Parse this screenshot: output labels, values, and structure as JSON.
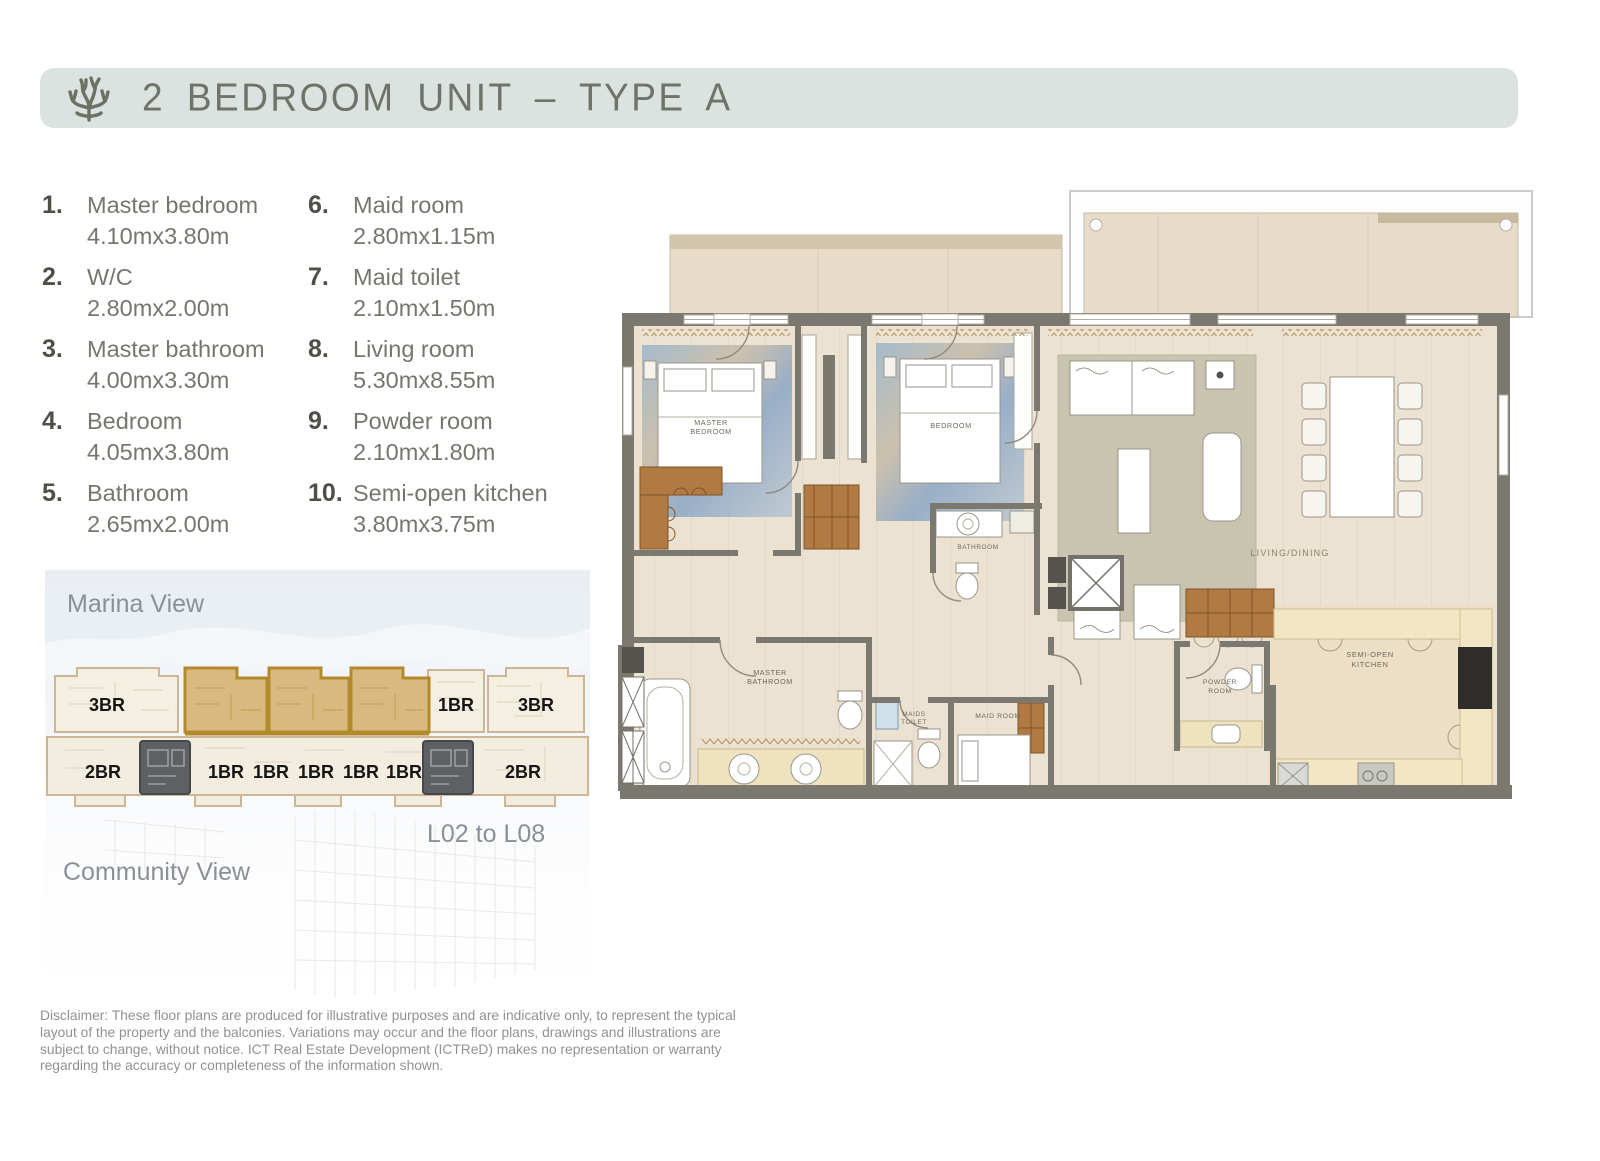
{
  "header": {
    "title": "2 BEDROOM UNIT – TYPE A"
  },
  "rooms": [
    {
      "num": "1.",
      "name": "Master bedroom",
      "dim": "4.10mx3.80m"
    },
    {
      "num": "2.",
      "name": "W/C",
      "dim": "2.80mx2.00m"
    },
    {
      "num": "3.",
      "name": "Master bathroom",
      "dim": "4.00mx3.30m"
    },
    {
      "num": "4.",
      "name": "Bedroom",
      "dim": "4.05mx3.80m"
    },
    {
      "num": "5.",
      "name": "Bathroom",
      "dim": "2.65mx2.00m"
    },
    {
      "num": "6.",
      "name": "Maid room",
      "dim": "2.80mx1.15m"
    },
    {
      "num": "7.",
      "name": "Maid toilet",
      "dim": "2.10mx1.50m"
    },
    {
      "num": "8.",
      "name": "Living room",
      "dim": "5.30mx8.55m"
    },
    {
      "num": "9.",
      "name": "Powder room",
      "dim": "2.10mx1.80m"
    },
    {
      "num": "10.",
      "name": "Semi-open kitchen",
      "dim": "3.80mx3.75m"
    }
  ],
  "locator": {
    "marina_view": "Marina View",
    "community_view": "Community View",
    "levels": "L02 to L08",
    "top_units": [
      "3BR",
      "1BR",
      "3BR"
    ],
    "bottom_units": [
      "2BR",
      "1BR",
      "1BR",
      "1BR",
      "1BR",
      "1BR",
      "2BR"
    ]
  },
  "plan_labels": {
    "master_bedroom_l1": "MASTER",
    "master_bedroom_l2": "BEDROOM",
    "bedroom": "BEDROOM",
    "bathroom": "BATHROOM",
    "living": "LIVING/DINING",
    "master_bath_l1": "MASTER",
    "master_bath_l2": "BATHROOM",
    "maids_toilet_l1": "MAIDS",
    "maids_toilet_l2": "TOILET",
    "maid_room": "MAID ROOM",
    "powder_l1": "POWDER",
    "powder_l2": "ROOM",
    "kitchen_l1": "SEMI-OPEN",
    "kitchen_l2": "KITCHEN"
  },
  "disclaimer": "Disclaimer: These floor plans are produced for illustrative purposes and are indicative only, to represent the typical layout of the property and the balconies. Variations may occur and the floor plans, drawings and illustrations are subject to change, without notice. ICT Real Estate Development (ICTReD) makes no representation or warranty regarding the accuracy or completeness of the information shown.",
  "colors": {
    "accent_gold": "#b28a2b",
    "header_bg": "#dce2e0",
    "header_text": "#6e746a",
    "legend_text": "#73786e",
    "diagram_text": "#899097",
    "wall_gray": "#7b786f",
    "floor_beige": "#ece2d2"
  }
}
